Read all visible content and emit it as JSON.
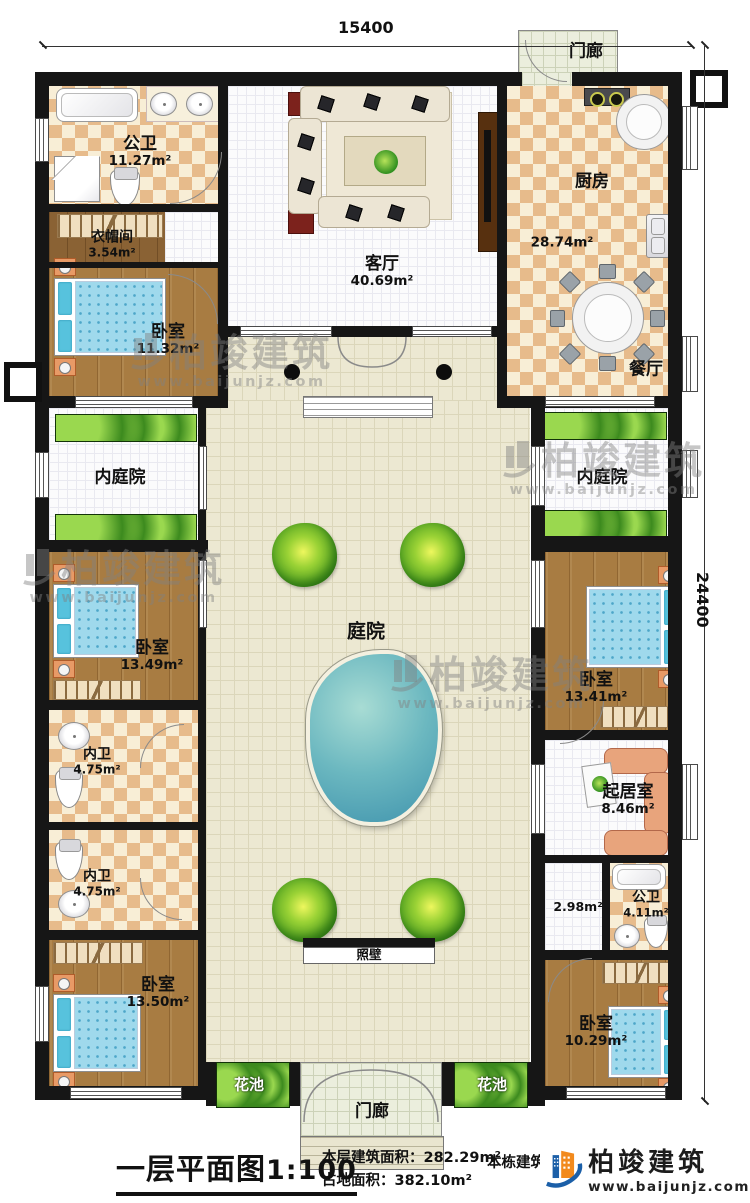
{
  "dimensions": {
    "top": "15400",
    "right": "24400"
  },
  "title": {
    "text": "一层平面图",
    "scale": "1:100"
  },
  "stats": [
    {
      "label": "本层建筑面积：",
      "value": "282.29m²"
    },
    {
      "label": "占地面积：",
      "value": "382.10m²"
    }
  ],
  "stats_extra": {
    "label": "本栋建筑面积："
  },
  "brand": {
    "name": "柏竣建筑",
    "url": "www.baijunjz.com"
  },
  "watermark": {
    "name": "柏竣建筑",
    "url": "www.baijunjz.com"
  },
  "rooms": {
    "gongwei_top": {
      "name": "公卫",
      "area": "11.27m²"
    },
    "yimaojian": {
      "name": "衣帽间",
      "area": "3.54m²"
    },
    "woshi_1": {
      "name": "卧室",
      "area": "11.32m²"
    },
    "keting": {
      "name": "客厅",
      "area": "40.69m²"
    },
    "chufang": {
      "name": "厨房",
      "area": "28.74m²"
    },
    "canting": {
      "name": "餐厅"
    },
    "menlang_top": {
      "name": "门廊"
    },
    "neitingyuan_left": {
      "name": "内庭院"
    },
    "neitingyuan_right": {
      "name": "内庭院"
    },
    "tingyuan": {
      "name": "庭院"
    },
    "woshi_2": {
      "name": "卧室",
      "area": "13.49m²"
    },
    "neiwei_1": {
      "name": "内卫",
      "area": "4.75m²"
    },
    "neiwei_2": {
      "name": "内卫",
      "area": "4.75m²"
    },
    "woshi_3": {
      "name": "卧室",
      "area": "13.50m²"
    },
    "woshi_right": {
      "name": "卧室",
      "area": "13.41m²"
    },
    "qijushi": {
      "name": "起居室",
      "area": "8.46m²"
    },
    "guodao": {
      "area": "2.98m²"
    },
    "gongwei_bottom": {
      "name": "公卫",
      "area": "4.11m²"
    },
    "woshi_4": {
      "name": "卧室",
      "area": "10.29m²"
    },
    "zhaobi": {
      "name": "照壁"
    },
    "huachi_left": {
      "name": "花池"
    },
    "huachi_right": {
      "name": "花池"
    },
    "menlang_bottom": {
      "name": "门廊"
    }
  }
}
